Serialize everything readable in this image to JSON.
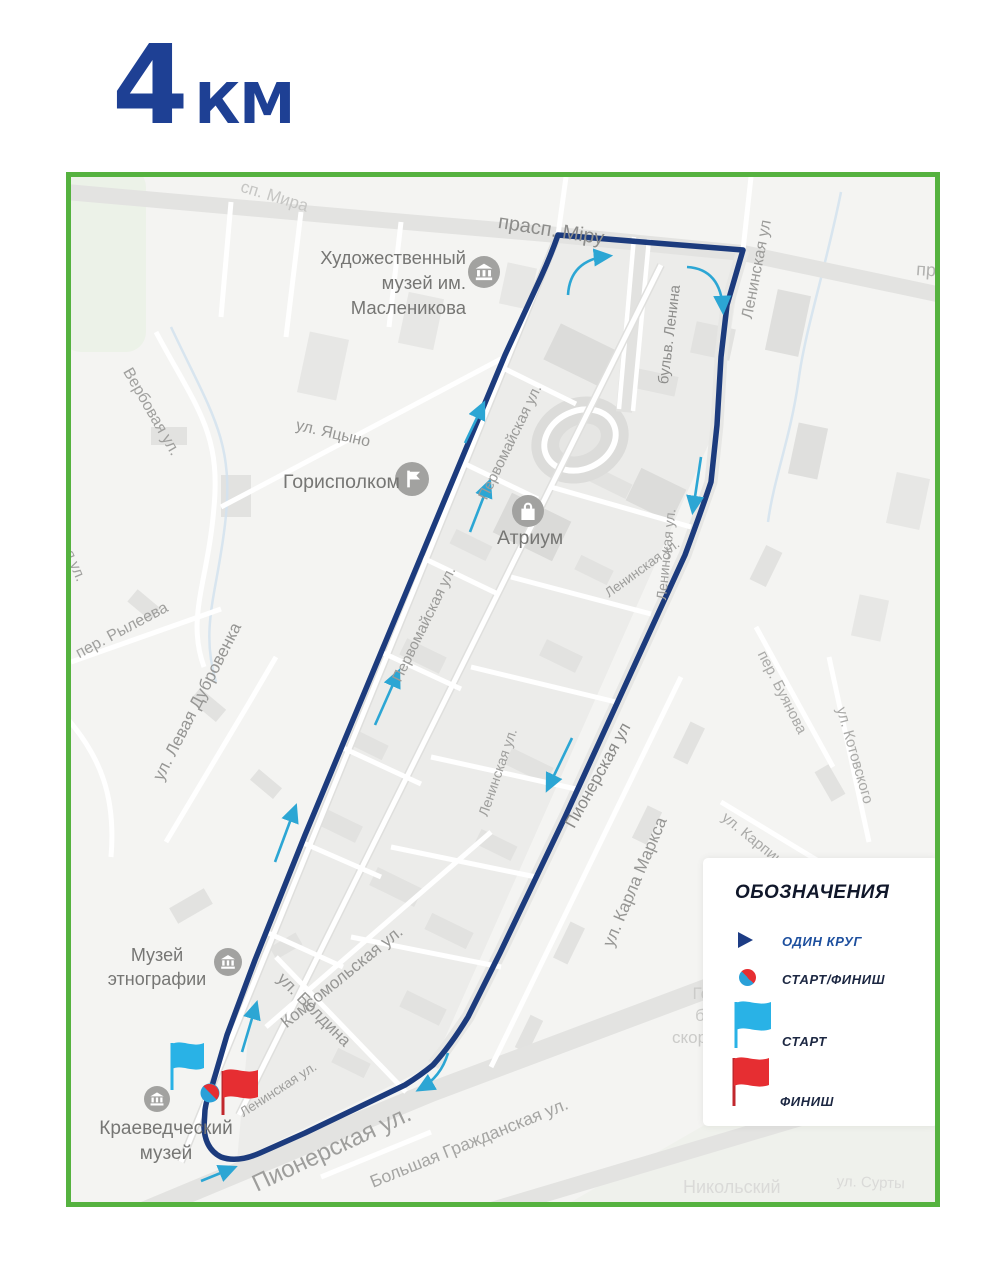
{
  "title": {
    "number": "4",
    "unit": "КМ"
  },
  "legend": {
    "title": "ОБОЗНАЧЕНИЯ",
    "items": {
      "lap": "ОДИН КРУГ",
      "start_finish": "СТАРТ/ФИНИШ",
      "start": "СТАРТ",
      "finish": "ФИНИШ"
    }
  },
  "map": {
    "streets": [
      {
        "text": "сп. Мира"
      },
      {
        "text": "прасп. Міру"
      },
      {
        "text": "пр"
      },
      {
        "text": "Ленинская ул"
      },
      {
        "text": "бульв. Ленина"
      },
      {
        "text": "ул. Яцыно"
      },
      {
        "text": "Первомайская ул."
      },
      {
        "text": "Первомайская ул."
      },
      {
        "text": "Ленинская ул."
      },
      {
        "text": "Ленинская ул."
      },
      {
        "text": "Ленинская ул."
      },
      {
        "text": "Пионерская ул"
      },
      {
        "text": "ул. Карла Маркса"
      },
      {
        "text": "ул. Карпинского"
      },
      {
        "text": "пер. Буянова"
      },
      {
        "text": "ул. Котовского"
      },
      {
        "text": "Вербовая ул."
      },
      {
        "text": "пер. Рылеева"
      },
      {
        "text": "ул. Левая Дубровенка"
      },
      {
        "text": "овая ул."
      },
      {
        "text": "Комсомольская ул."
      },
      {
        "text": "ул. Болдина"
      },
      {
        "text": "Ленинская ул."
      },
      {
        "text": "Пионерская ул."
      },
      {
        "text": "Большая Гражданская ул."
      },
      {
        "text": "Никольский"
      },
      {
        "text": "ул. Сурты"
      }
    ],
    "landmarks": {
      "art_museum": [
        "Художественный",
        "музей им.",
        "Масленикова"
      ],
      "gorispolkom": "Горисполком",
      "atrium": "Атриум",
      "ethnography_museum": [
        "Музей",
        "этнографии"
      ],
      "local_history_museum": [
        "Краеведческий",
        "музей"
      ],
      "hospital": [
        "Городская",
        "больница",
        "скорой помощи"
      ]
    }
  },
  "colors": {
    "route": "#1c3b7d",
    "direction_arrow": "#2ca6d4",
    "map_border": "#55b23f",
    "title_blue": "#1e4094",
    "start_flag": "#29b2e6",
    "finish_flag": "#e62e32"
  }
}
